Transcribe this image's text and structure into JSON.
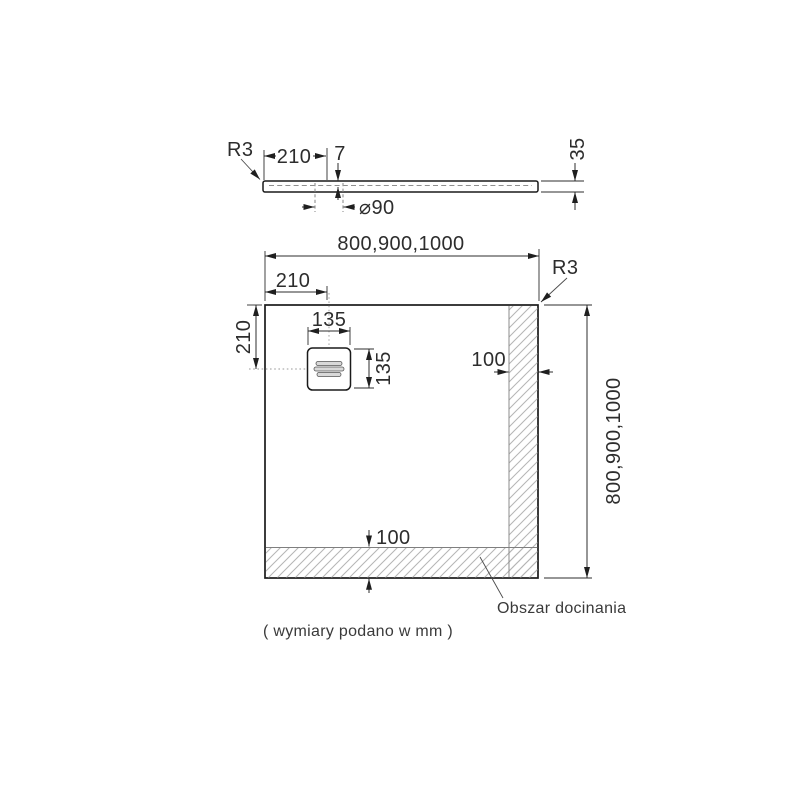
{
  "side_view": {
    "radius_label": "R3",
    "edge_to_drain": "210",
    "recess_depth": "7",
    "tray_height": "35",
    "drain_diameter": "⌀90"
  },
  "plan_view": {
    "width_options": "800,900,1000",
    "height_options": "800,900,1000",
    "drain_offset_x": "210",
    "drain_offset_y": "210",
    "drain_cover_width": "135",
    "drain_cover_height": "135",
    "trim_right": "100",
    "trim_bottom": "100",
    "corner_radius_label": "R3"
  },
  "notes": {
    "trim_area": "Obszar docinania",
    "units": "( wymiary podano w mm )"
  },
  "colors": {
    "outline": "#1a1a1a",
    "dimension_text": "#2d2d2d",
    "hatch": "#b5b5b5",
    "background": "#ffffff"
  }
}
